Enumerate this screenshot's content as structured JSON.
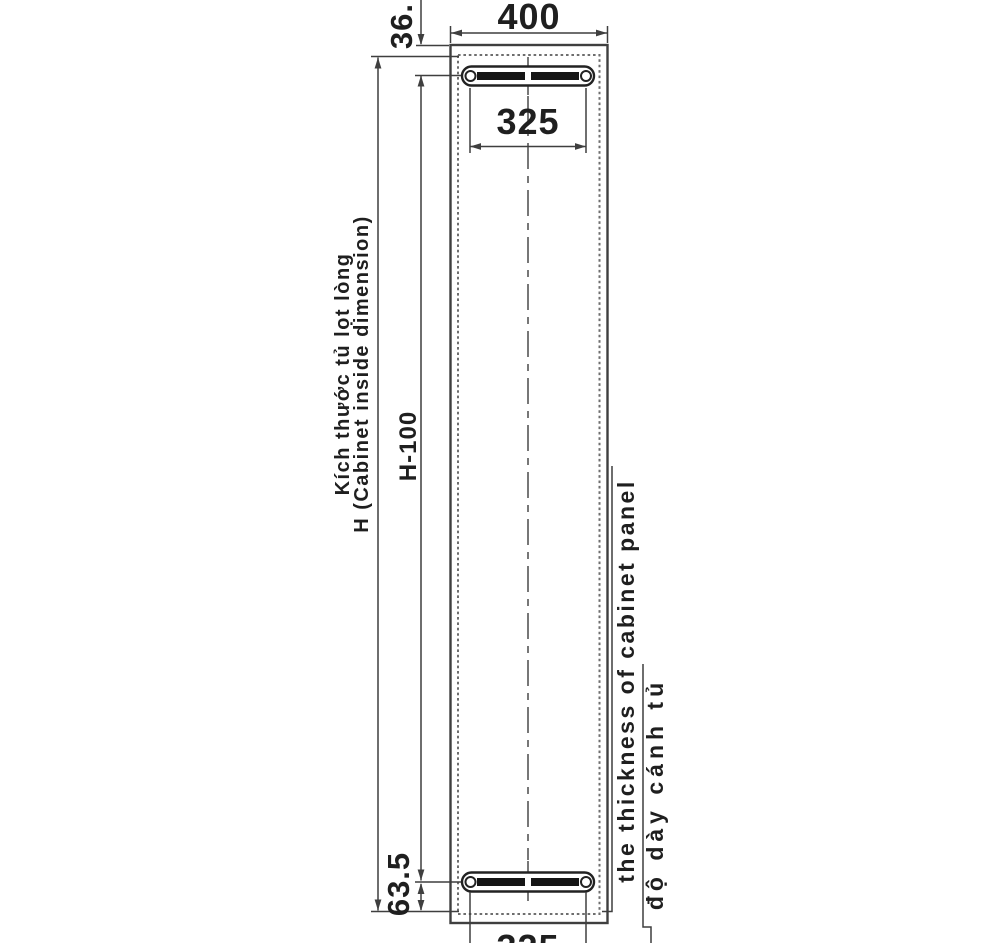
{
  "drawing": {
    "type": "cabinet front elevation with hanging rail positions",
    "dims": {
      "cabinet_width": "400",
      "rail_width_top": "325",
      "rail_width_bottom": "325",
      "top_rail_offset": "36.",
      "bottom_rail_offset": "63.5",
      "rail_spacing": "H-100"
    },
    "labels": {
      "inside_height_vi": "Kích thước tủ lọt lòng",
      "inside_height_en": "H (Cabinet inside dimension)",
      "panel_thickness_en": "the thickness of cabinet panel",
      "panel_thickness_vi": "độ dày cánh tủ"
    },
    "colors": {
      "background": "#ffffff",
      "solid_line": "#3f3f3f",
      "dashed_line": "#6e6e6e",
      "rail": "#1c1c1c",
      "text": "#1f1f1f"
    }
  }
}
